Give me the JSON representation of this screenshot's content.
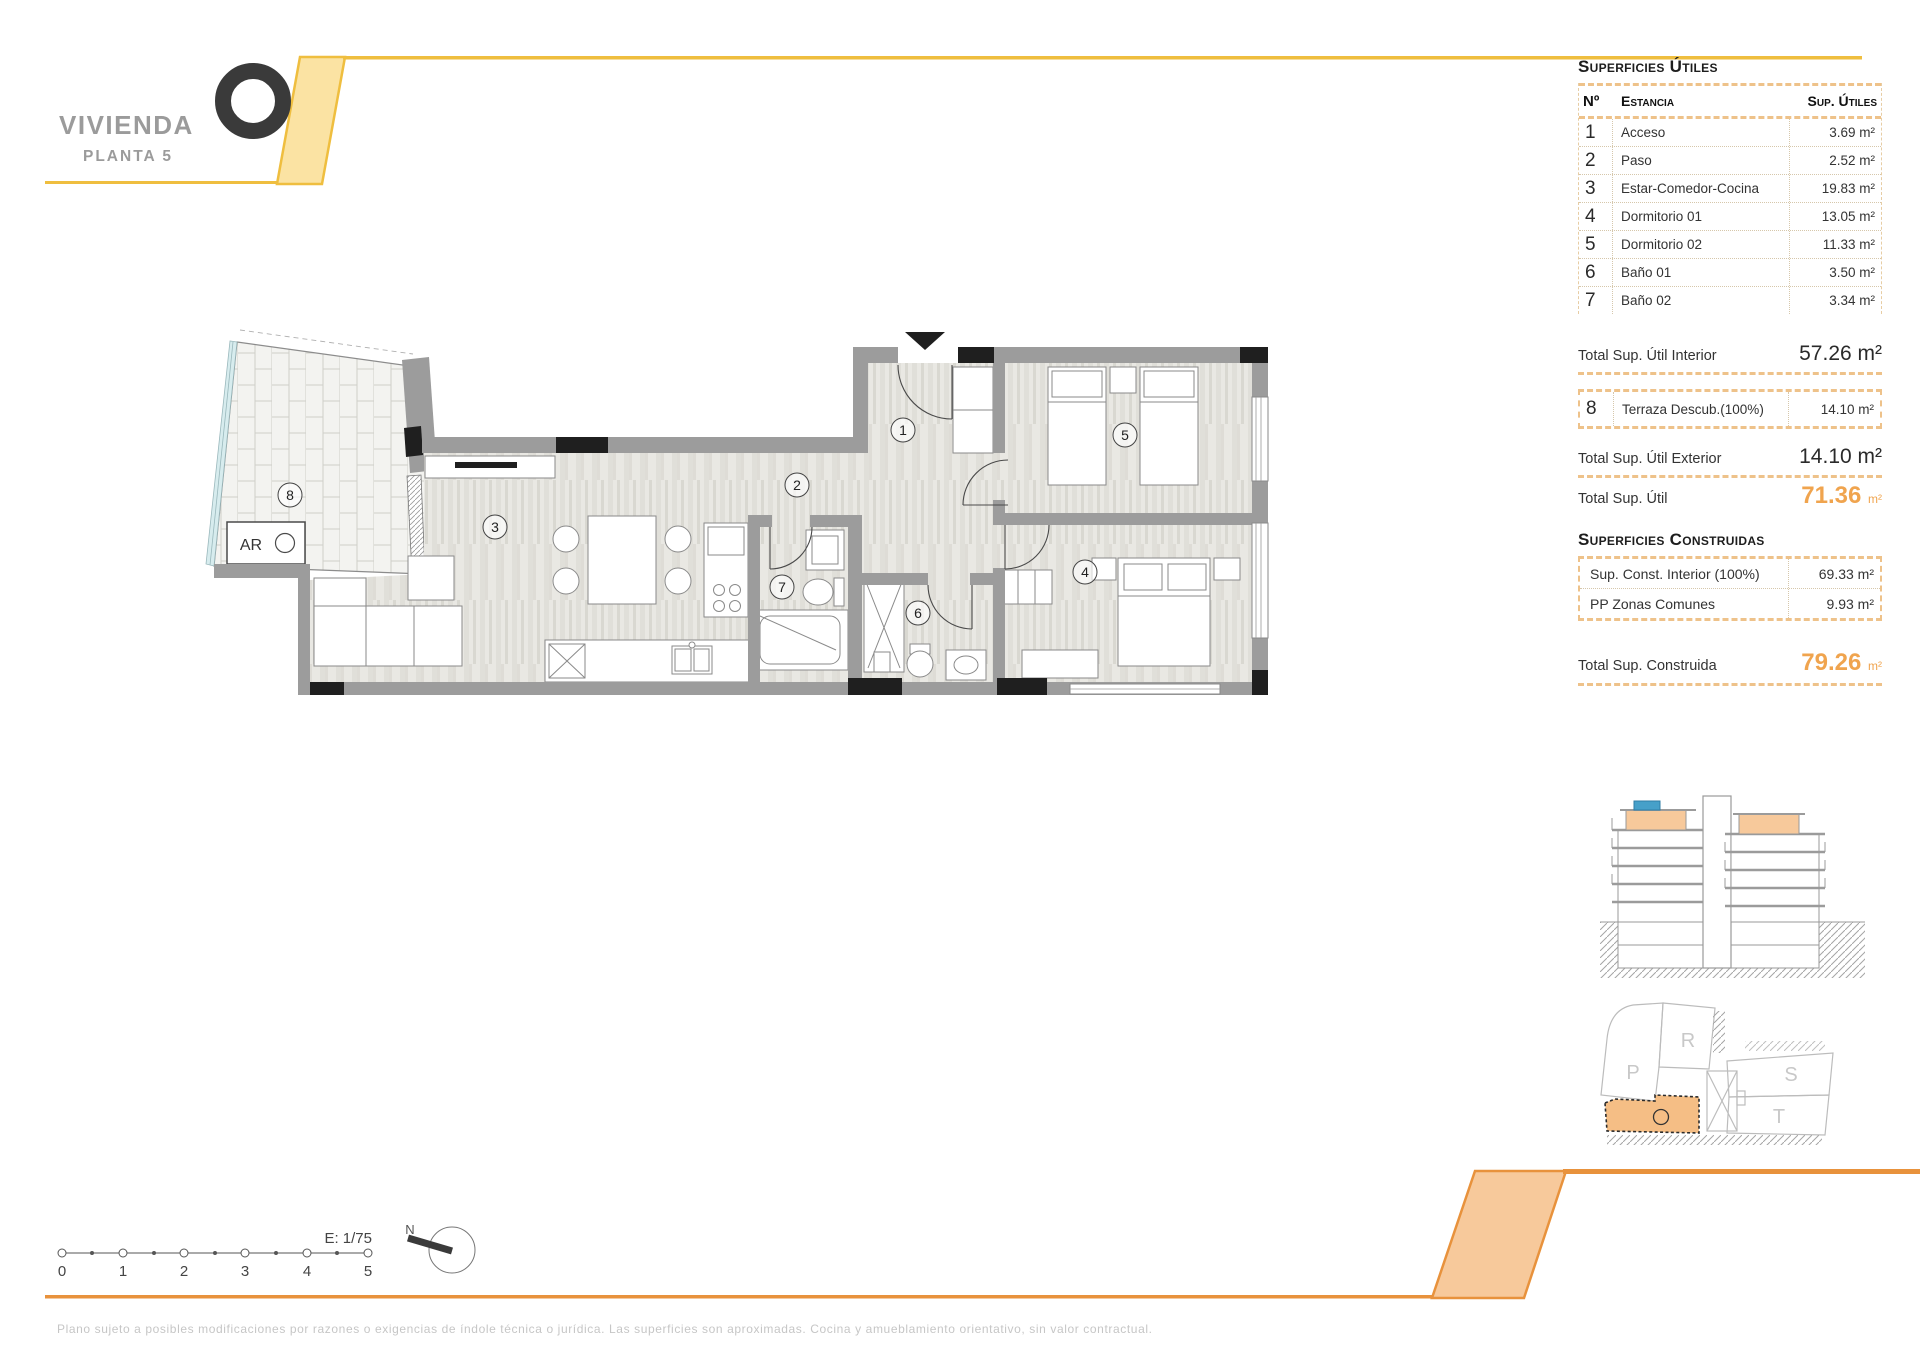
{
  "logo": {
    "title": "VIVIENDA",
    "subtitle": "PLANTA 5"
  },
  "su": {
    "title": "Superficies Útiles",
    "headers": {
      "num": "Nº",
      "name": "Estancia",
      "value": "Sup. Útiles"
    },
    "rows": [
      {
        "n": "1",
        "name": "Acceso",
        "value": "3.69 m²"
      },
      {
        "n": "2",
        "name": "Paso",
        "value": "2.52 m²"
      },
      {
        "n": "3",
        "name": "Estar-Comedor-Cocina",
        "value": "19.83 m²"
      },
      {
        "n": "4",
        "name": "Dormitorio 01",
        "value": "13.05 m²"
      },
      {
        "n": "5",
        "name": "Dormitorio 02",
        "value": "11.33 m²"
      },
      {
        "n": "6",
        "name": "Baño 01",
        "value": "3.50 m²"
      },
      {
        "n": "7",
        "name": "Baño 02",
        "value": "3.34 m²"
      }
    ],
    "total_interior": {
      "label": "Total Sup. Útil Interior",
      "value": "57.26 m²"
    },
    "terrace": {
      "n": "8",
      "name": "Terraza Descub.(100%)",
      "value": "14.10 m²"
    },
    "total_exterior": {
      "label": "Total Sup. Útil Exterior",
      "value": "14.10 m²"
    },
    "total_util": {
      "label": "Total Sup. Útil",
      "value": "71.36",
      "unit": "m²"
    }
  },
  "sc": {
    "title": "Superficies Construidas",
    "rows": [
      {
        "name": "Sup. Const. Interior (100%)",
        "value": "69.33 m²"
      },
      {
        "name": "PP Zonas Comunes",
        "value": "9.93 m²"
      }
    ],
    "total": {
      "label": "Total Sup. Construida",
      "value": "79.26",
      "unit": "m²"
    }
  },
  "plan": {
    "room_labels": [
      "1",
      "2",
      "3",
      "4",
      "5",
      "6",
      "7",
      "8"
    ],
    "ar_label": "AR"
  },
  "scalebar": {
    "scale_label": "E: 1/75",
    "north_label": "N",
    "ticks": [
      "0",
      "1",
      "2",
      "3",
      "4",
      "5"
    ]
  },
  "site_key": {
    "r": "R",
    "p": "P",
    "s": "S",
    "t": "T"
  },
  "footer": {
    "disclaimer": "Plano sujeto a posibles modificaciones por razones o exigencias de índole técnica o jurídica. Las superficies son aproximadas. Cocina y amueblamiento orientativo, sin valor contractual."
  },
  "colors": {
    "yellow_line": "#EFBE3F",
    "yellow_fill": "#FBE3A3",
    "orange_line": "#E8923C",
    "orange_fill": "#F7C99B",
    "accent_total": "#F0A44E",
    "wall_gray": "#9C9C9C",
    "pool_blue": "#46A0C9"
  }
}
